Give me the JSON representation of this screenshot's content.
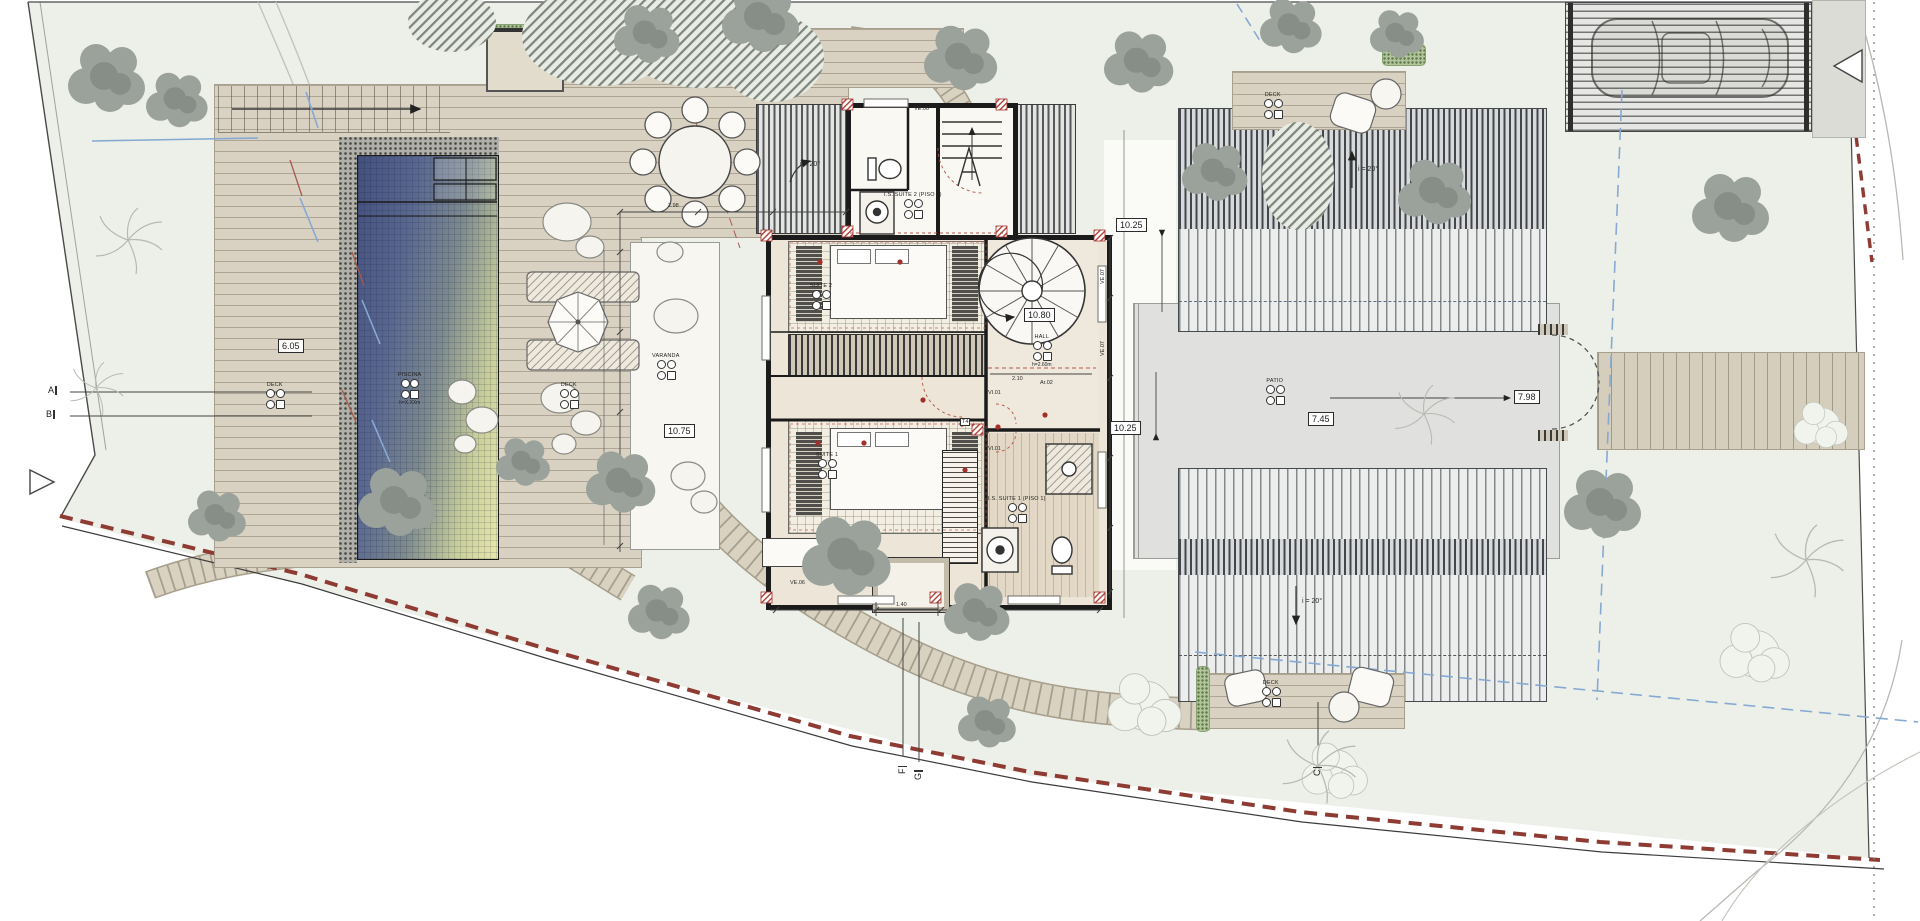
{
  "plan": {
    "areas": {
      "piscina": {
        "label": "PISCINA",
        "depth": "h=X.XXm"
      },
      "deck": {
        "label": "DECK"
      },
      "varanda": {
        "label": "VARANDA"
      },
      "suite1": {
        "label": "SUITE 1"
      },
      "suite2": {
        "label": "SUITE 2"
      },
      "is_suite1": {
        "label": "I.S. SUITE 1 (PISO 1)"
      },
      "is_suite2": {
        "label": "I.S. SUITE 2 (PISO 1)"
      },
      "hall": {
        "label": "HALL",
        "height": "h=2.60m"
      },
      "patio": {
        "label": "PATIO"
      }
    },
    "dimensions": {
      "pool_zone": "6.05",
      "varanda_zone": "10.75",
      "hall_zone": "10.80",
      "roof_top": "10.25",
      "roof_bottom": "10.25",
      "patio_zone": "7.45",
      "gate": "7.98",
      "porch": "1.40",
      "deck_span": "2.98",
      "hall_span": "2.10"
    },
    "annotations": {
      "slope": "i = 20°",
      "ve06": "VE.06",
      "ve07": "VE.07",
      "vi01": "VI.01",
      "t4": "T4",
      "ar02": "Ar.02"
    },
    "markers": {
      "a": "A",
      "b": "B",
      "c": "C",
      "f": "F",
      "g": "G"
    },
    "colors": {
      "site": "#edf0e8",
      "deck": "#d9d2c2",
      "pool_deep": "#42507c",
      "pool_shallow": "#e6e7ab",
      "patio": "#e0e0df",
      "boundary_dash": "#8e3b34",
      "utility_blue": "#86a9d4",
      "accent_red": "#b03a30"
    }
  }
}
